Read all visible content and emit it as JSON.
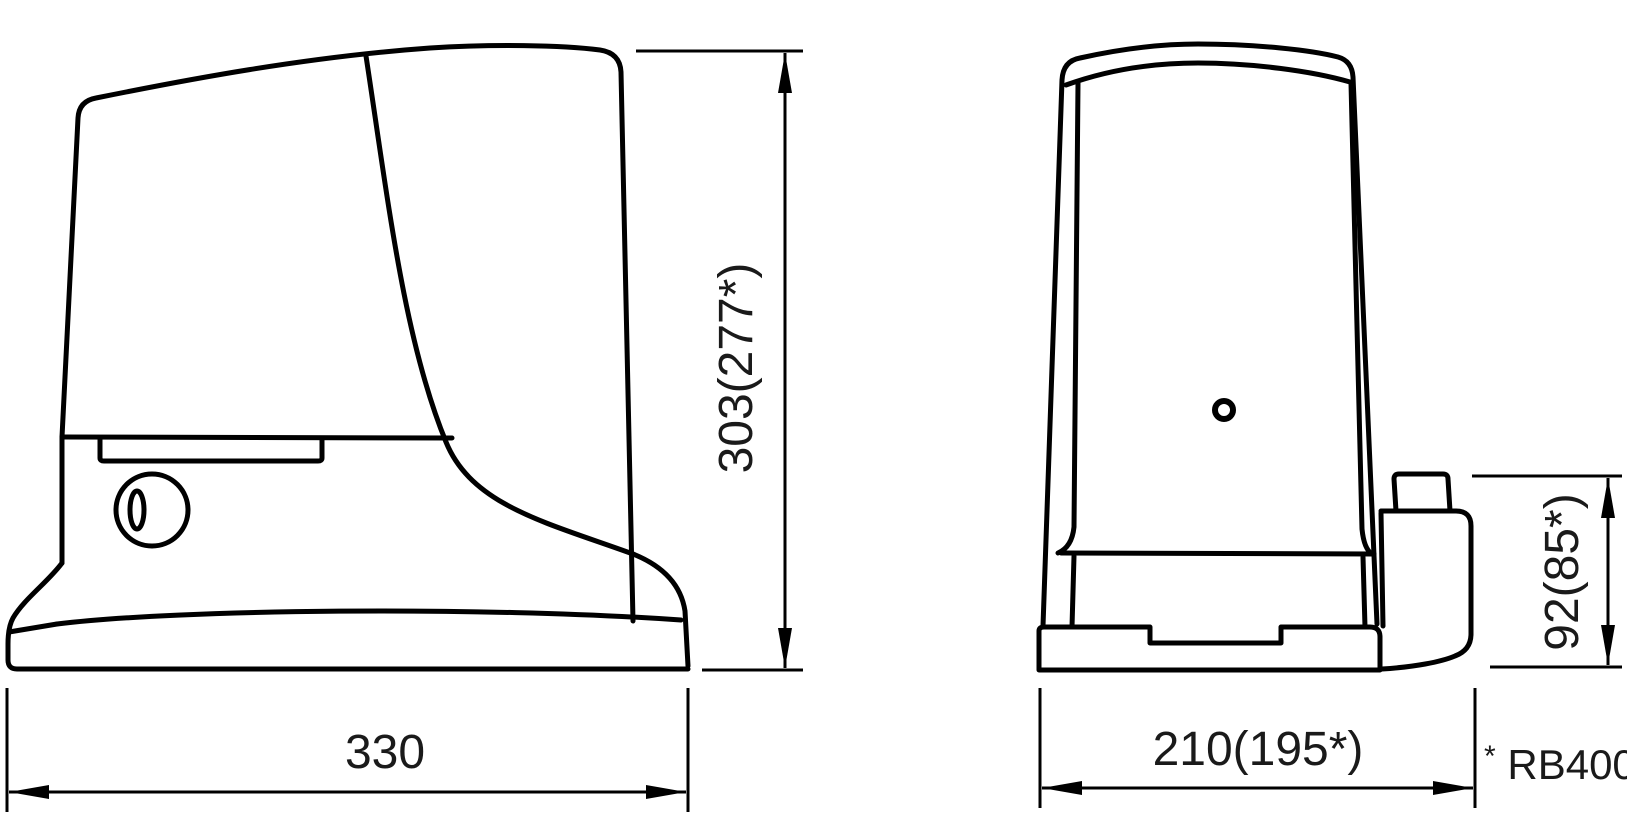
{
  "colors": {
    "background": "#ffffff",
    "line": "#000000",
    "text": "#1a1a1a"
  },
  "side_view": {
    "description": "side profile of gearmotor with cover seam, release keyhole and base plate",
    "width_dimension": "330",
    "height_dimension": "303(277*)"
  },
  "front_view": {
    "description": "front of gearmotor with indicator hole, base plate and rear release housing",
    "width_dimension": "210(195*)",
    "rear_height_dimension": "92(85*)"
  },
  "footnote": {
    "marker": "*",
    "text": "RB400"
  }
}
